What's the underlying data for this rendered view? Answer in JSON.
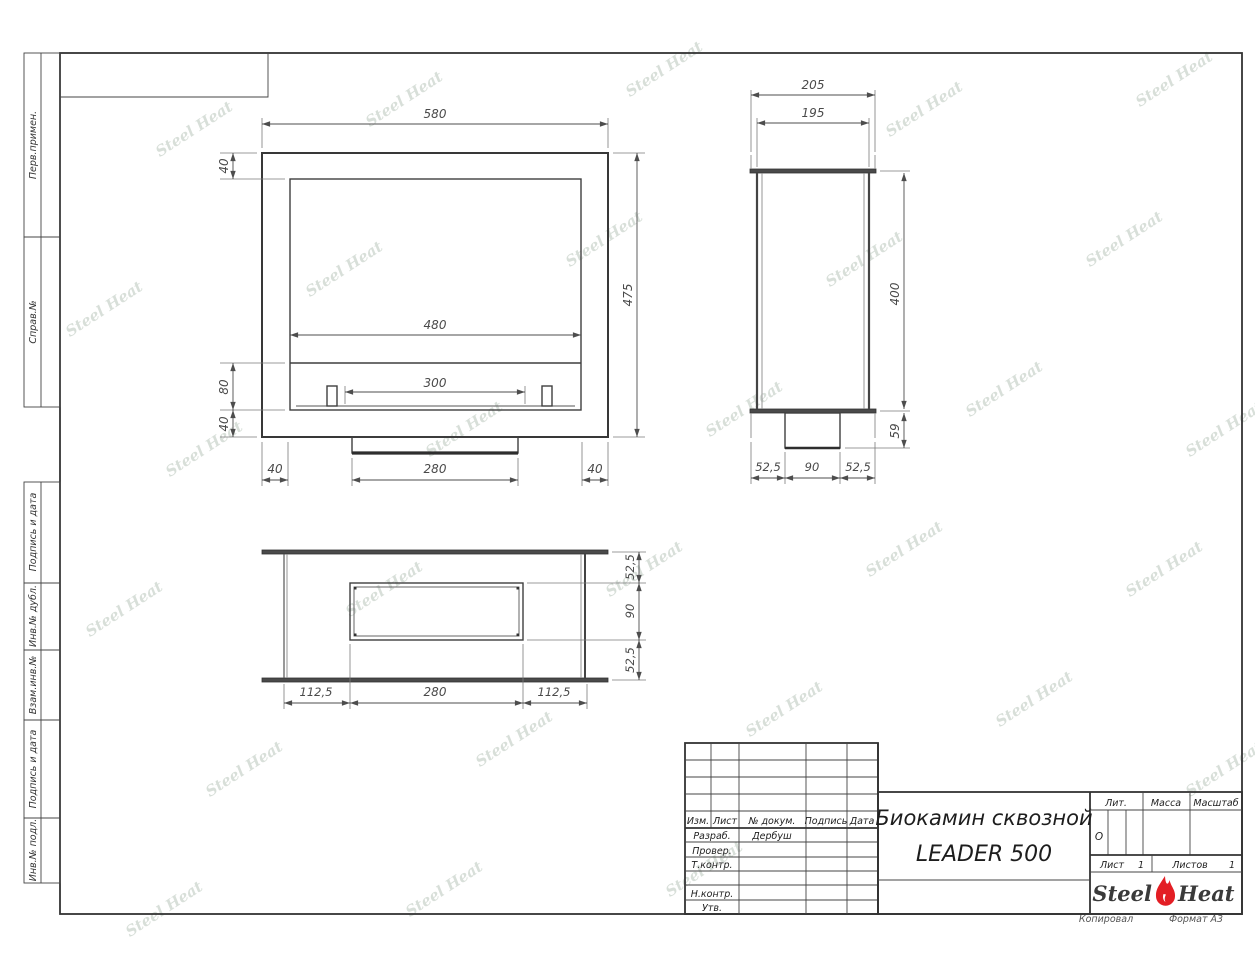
{
  "watermark": {
    "text": "Steel Heat"
  },
  "frame": {
    "copied_note": "Копировал",
    "format_note": "Формат А3"
  },
  "sidebar": {
    "items": [
      {
        "label": "Перв.примен."
      },
      {
        "label": "Справ.№"
      },
      {
        "label": "Подпись и дата"
      },
      {
        "label": "Инв.№ дубл."
      },
      {
        "label": "Взам.инв.№"
      },
      {
        "label": "Подпись и дата"
      },
      {
        "label": "Инв.№ подл."
      }
    ]
  },
  "views": {
    "front": {
      "dims": {
        "overall_width": "580",
        "window_width": "480",
        "burner_width": "300",
        "overall_height": "475",
        "top_wall": "40",
        "shelf_height": "80",
        "bottom_wall": "40",
        "left_wall": "40",
        "tray_width": "280",
        "right_wall": "40"
      }
    },
    "side": {
      "dims": {
        "flange_depth": "205",
        "body_depth": "195",
        "body_height": "400",
        "box_height": "59",
        "offset_left": "52,5",
        "box_width": "90",
        "offset_right": "52,5"
      }
    },
    "top": {
      "dims": {
        "offset_left": "112,5",
        "opening_width": "280",
        "offset_right": "112,5",
        "offset_top": "52,5",
        "opening_depth": "90",
        "offset_bottom": "52,5"
      }
    }
  },
  "title_block": {
    "header": {
      "izm": "Изм.",
      "list": "Лист",
      "doc": "№ докум.",
      "sign": "Подпись",
      "date": "Дата"
    },
    "roles": {
      "developed": "Разраб.",
      "checked": "Провер.",
      "tcontrol": "Т.контр.",
      "ncontrol": "Н.контр.",
      "approved": "Утв."
    },
    "developer_name": "Дербуш",
    "title_line1": "Биокамин сквозной",
    "title_line2": "LEADER 500",
    "lit_label": "Лит.",
    "lit_value": "О",
    "mass_label": "Масса",
    "scale_label": "Масштаб",
    "sheet_label": "Лист",
    "sheet_number": "1",
    "sheets_label": "Листов",
    "sheets_total": "1",
    "logo": {
      "part1": "Steel",
      "part2": "Heat",
      "flame_color": "#e31e24"
    }
  }
}
